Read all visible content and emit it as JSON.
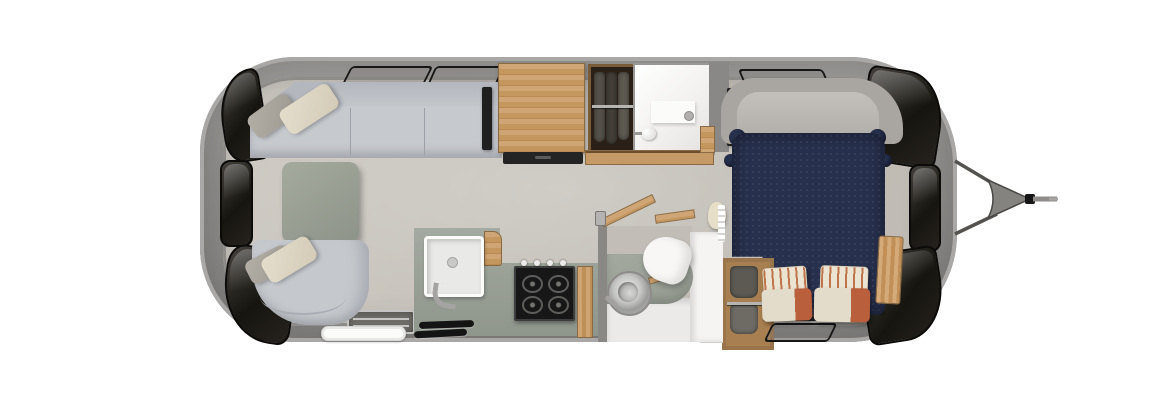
{
  "scene": {
    "title": "Travel trailer floor plan, top-down rendered view",
    "background": "#ffffff"
  },
  "palette": {
    "shell": "#8f8d8b",
    "shell_rim": "#aaa8a6",
    "floor": "#c7c3bc",
    "window_glass": "#17150f",
    "upholstery": "#c6c9ce",
    "table": "#9aa094",
    "wood": "#c59a66",
    "counter": "#99a096",
    "bed_duvet": "#27304d",
    "pillow_cream": "#e4dcca",
    "pillow_orange": "#b95f3c",
    "white_fixture": "#f6f5f3"
  },
  "items": {
    "shell": {
      "label": "trailer body shell"
    },
    "floor": {
      "label": "interior floor"
    },
    "window": {
      "label": "tinted window"
    },
    "roof_vent": {
      "label": "roof vent outline"
    },
    "hitch": {
      "label": "tow hitch and A-frame"
    },
    "sofa": {
      "label": "rear sectional sofa"
    },
    "pillow": {
      "label": "throw pillow"
    },
    "table": {
      "label": "table"
    },
    "chair": {
      "label": "lounge chair"
    },
    "tv": {
      "label": "tv panel"
    },
    "fridge": {
      "label": "wood-top refrigerator cabinet"
    },
    "vent_drawer": {
      "label": "vented appliance drawer"
    },
    "wardrobe_top": {
      "label": "wardrobe with hanging clothes"
    },
    "shower": {
      "label": "shower stall"
    },
    "sill": {
      "label": "wood sill counter"
    },
    "carpet": {
      "label": "bed head carpet"
    },
    "headboard": {
      "label": "upholstered headboard"
    },
    "bed": {
      "label": "bed with navy duvet"
    },
    "bed_pillow_striped": {
      "label": "striped accent pillow"
    },
    "bed_pillow_body": {
      "label": "two-tone bed pillow"
    },
    "nightstand": {
      "label": "wood nightstand"
    },
    "wardrobe_rear": {
      "label": "bedside wardrobe"
    },
    "wardrobe_door": {
      "label": "open wardrobe door"
    },
    "bath_wall": {
      "label": "bathroom partition wall"
    },
    "vanity": {
      "label": "bathroom vanity counter"
    },
    "toilet": {
      "label": "toilet"
    },
    "vessel_sink": {
      "label": "round vessel sink"
    },
    "bath_door": {
      "label": "open bathroom door"
    },
    "bath_shelf": {
      "label": "wood shelf"
    },
    "towel": {
      "label": "hanging towel"
    },
    "accordion_door": {
      "label": "folding accordion door"
    },
    "kitchen_counter": {
      "label": "galley counter"
    },
    "kitchen_sink": {
      "label": "kitchen sink"
    },
    "kitchen_faucet": {
      "label": "kitchen faucet"
    },
    "cooktop": {
      "label": "gas cooktop"
    },
    "kitchen_cabinet": {
      "label": "wood cabinet panel"
    },
    "floor_vent": {
      "label": "floor vent slats"
    },
    "entry_door": {
      "label": "entry step recess"
    },
    "entry_step": {
      "label": "exterior entry step"
    }
  }
}
